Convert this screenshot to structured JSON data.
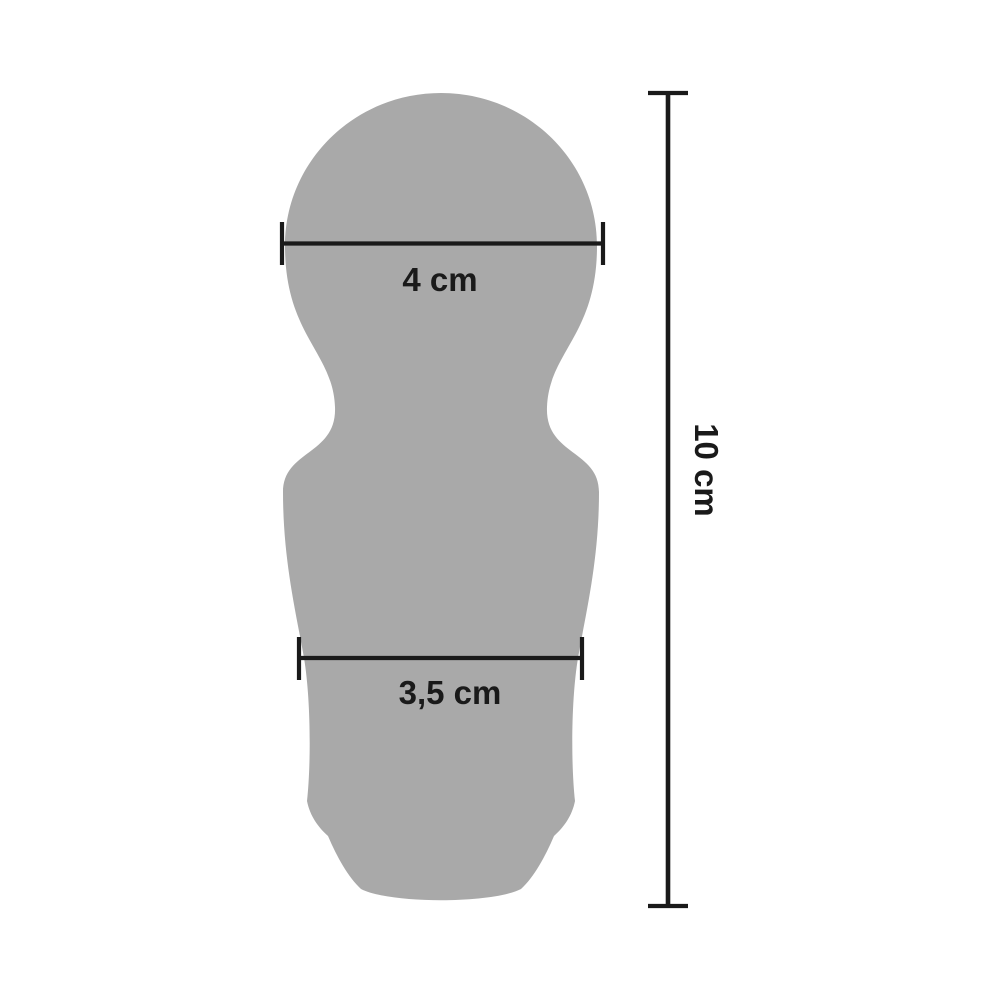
{
  "colors": {
    "background": "#ffffff",
    "shape_fill": "#a9a9a9",
    "dimension_line": "#1a1a1a",
    "label_text": "#1a1a1a"
  },
  "diagram": {
    "measurements": {
      "head_width": {
        "label": "4 cm"
      },
      "body_width": {
        "label": "3,5 cm"
      },
      "total_height": {
        "label": "10 cm"
      }
    }
  }
}
